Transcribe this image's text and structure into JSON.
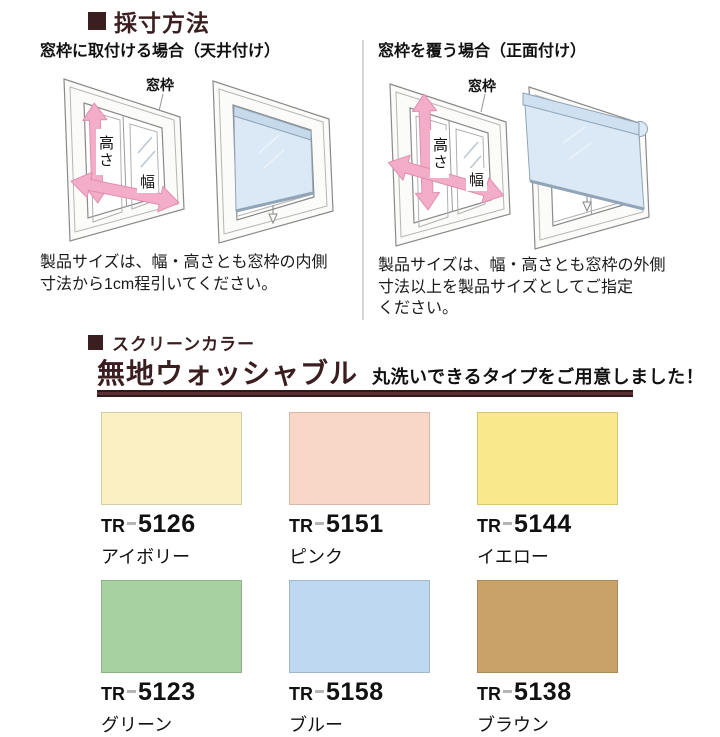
{
  "colors": {
    "accent_dark": "#3a1e20",
    "arrow_pink": "#f4adc8",
    "screen_blue": "#dbe9f6",
    "divider_gray": "#d6d6d6"
  },
  "measure_section": {
    "title": "採寸方法",
    "left": {
      "subtitle": "窓枠に取付ける場合（天井付け）",
      "caption": "製品サイズは、幅・高さとも窓枠の内側\n寸法から1cm程引いてください。"
    },
    "right": {
      "subtitle": "窓枠を覆う場合（正面付け）",
      "caption": "製品サイズは、幅・高さとも窓枠の外側\n寸法以上を製品サイズとしてご指定\nください。"
    },
    "diagram_labels": {
      "window_frame": "窓枠",
      "height": "高さ",
      "width": "幅"
    }
  },
  "color_section": {
    "title": "スクリーンカラー",
    "headline": "無地ウォッシャブル",
    "tagline": "丸洗いできるタイプをご用意しました！",
    "swatches": [
      {
        "prefix": "TR",
        "code": "5126",
        "name": "アイボリー",
        "color": "#fbf0c4"
      },
      {
        "prefix": "TR",
        "code": "5151",
        "name": "ピンク",
        "color": "#f8d7c6"
      },
      {
        "prefix": "TR",
        "code": "5144",
        "name": "イエロー",
        "color": "#fae98c"
      },
      {
        "prefix": "TR",
        "code": "5123",
        "name": "グリーン",
        "color": "#a7d1a0"
      },
      {
        "prefix": "TR",
        "code": "5158",
        "name": "ブルー",
        "color": "#bdd8f0"
      },
      {
        "prefix": "TR",
        "code": "5138",
        "name": "ブラウン",
        "color": "#c9a26a"
      }
    ]
  }
}
